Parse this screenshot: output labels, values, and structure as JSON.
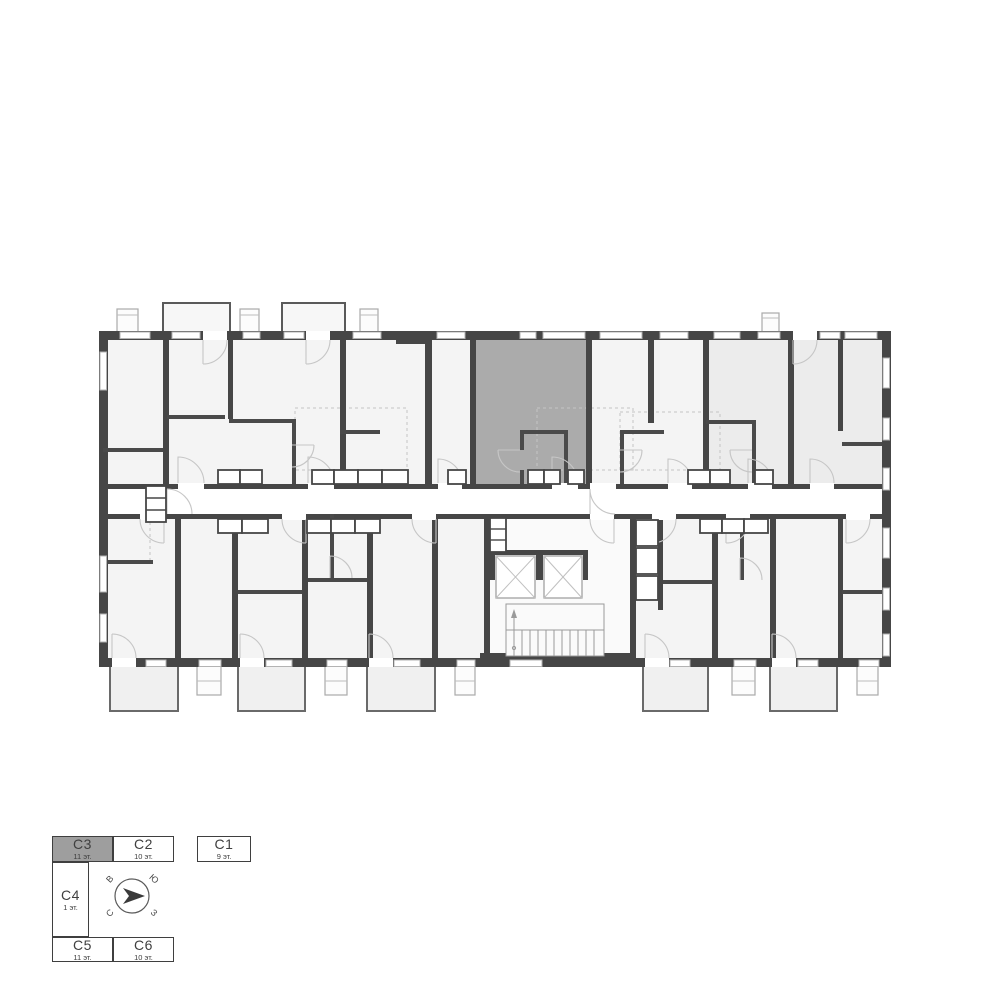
{
  "floorplan": {
    "colors": {
      "wall": "#464646",
      "room": "#f4f4f4",
      "corridor": "#ffffff",
      "highlight": "#ababab",
      "adjacent_section": "#ececec",
      "door_arc": "#c6c6c6"
    },
    "highlighted_unit": {
      "section": "C3"
    }
  },
  "legend": {
    "sections": [
      {
        "id": "C3",
        "floors": "11 эт.",
        "selected": true
      },
      {
        "id": "C2",
        "floors": "10 эт.",
        "selected": false
      },
      {
        "id": "C1",
        "floors": "9 эт.",
        "selected": false
      },
      {
        "id": "C4",
        "floors": "1 эт.",
        "selected": false
      },
      {
        "id": "C5",
        "floors": "11 эт.",
        "selected": false
      },
      {
        "id": "C6",
        "floors": "10 эт.",
        "selected": false
      }
    ],
    "compass": {
      "nw": "В",
      "ne": "Ю",
      "sw": "С",
      "se": "З"
    }
  }
}
